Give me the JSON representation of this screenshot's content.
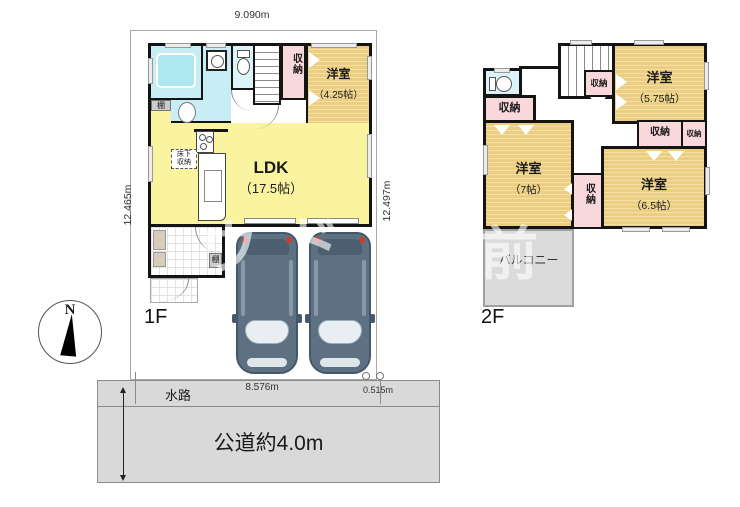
{
  "labels": {
    "floor1": "1F",
    "floor2": "2F",
    "north": "N"
  },
  "dimensions": {
    "top": "9.090m",
    "left": "12.465m",
    "right": "12.497m",
    "frontage": "8.576m",
    "corner": "0.515m"
  },
  "floor1": {
    "ldk": {
      "name": "LDK",
      "size": "（17.5帖）"
    },
    "western_room": {
      "name": "洋室",
      "size": "（4.25帖）"
    },
    "closet": "収納",
    "shelf_top": "棚",
    "shelf_entry": "棚",
    "underfloor": {
      "line1": "床下",
      "line2": "収納"
    }
  },
  "floor2": {
    "western_room_575": {
      "name": "洋室",
      "size": "（5.75帖）"
    },
    "western_room_7": {
      "name": "洋室",
      "size": "（7帖）"
    },
    "western_room_65": {
      "name": "洋室",
      "size": "（6.5帖）"
    },
    "closet_by_stairs": "収納",
    "closet_left": "収納",
    "closet_mid": "収納",
    "closet_mid_small": "収納",
    "closet_between": "収納",
    "balcony": "バルコニー"
  },
  "site": {
    "waterway": "水路",
    "road": "公道約4.0m"
  },
  "watermark": {
    "g1": "ウ",
    "g2": "ド",
    "g3": "前"
  },
  "colors": {
    "wall": "#141414",
    "ldk": "#FAF4A0",
    "tatami": "#ECCE82",
    "closet": "#F9D8DC",
    "bath": "#C9EDF4",
    "balcony": "#DBDBDB",
    "road": "#D9D9D9",
    "car": "#5D7183",
    "taillight": "#D03A2A"
  }
}
